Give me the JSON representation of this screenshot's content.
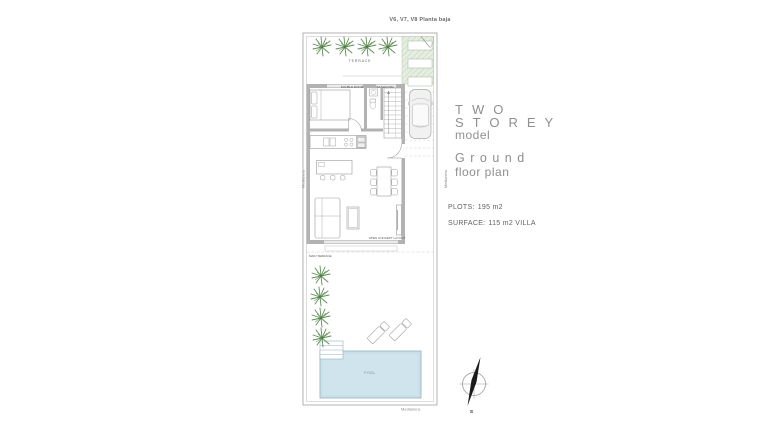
{
  "plan": {
    "variant_label": "V6, V7, V8 Planta baja",
    "labels": {
      "terrace": "TERRACE",
      "double_room": "DOUBLE ROOM",
      "bathroom": "BATHROOM",
      "open_concept": "OPEN CONCEPT LAYOUT",
      "main_terrace": "MAIN TERRACE",
      "pool": "POOL",
      "party_wall_left": "Medianera",
      "party_wall_right": "Medianera",
      "party_wall_bottom": "Medianera"
    }
  },
  "info_panel": {
    "title_line1": "TWO",
    "title_line2": "STOREY",
    "title_sub": "model",
    "plan_title": "Ground",
    "plan_sub": "floor plan",
    "specs": [
      {
        "label": "PLOTS:",
        "value": "195 m2"
      },
      {
        "label": "SURFACE:",
        "value": "115 m2 VILLA"
      }
    ]
  },
  "compass": {
    "south_label": "S"
  },
  "colors": {
    "wall_gray": "#b2b2b2",
    "line_gray": "#9a9a9a",
    "palm_green": "#5d8c55",
    "garden_green": "#e6eee1",
    "pool_blue": "#cfe4ec",
    "title_gray": "#8f8f8f"
  }
}
